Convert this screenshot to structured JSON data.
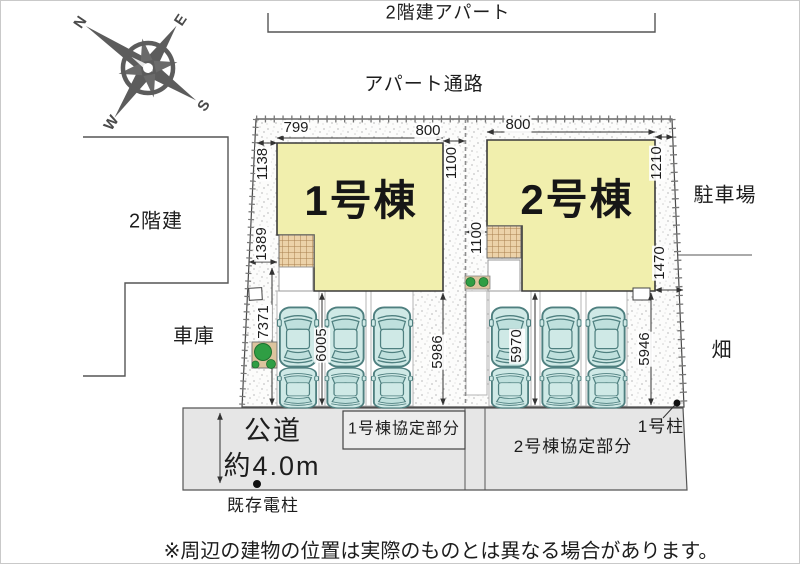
{
  "header": {
    "apartment_label": "2階建アパート",
    "passage_label": "アパート通路"
  },
  "compass": {
    "n": "N",
    "e": "E",
    "s": "S",
    "w": "W"
  },
  "surroundings": {
    "left_building": "2階建",
    "garage": "車庫",
    "parking_lot": "駐車場",
    "field": "畑"
  },
  "buildings": {
    "unit1": "1号棟",
    "unit2": "2号棟"
  },
  "road": {
    "name": "公道",
    "width": "約4.0m",
    "existing_pole": "既存電柱",
    "pole_no1": "1号柱",
    "agreement_unit1": "1号棟協定部分",
    "agreement_unit2": "2号棟協定部分"
  },
  "dimensions": {
    "b1_top_left": "799",
    "b1_top_right": "800",
    "b2_top_left": "800",
    "west_1": "1138",
    "west_2": "1389",
    "west_3": "7371",
    "center_north": "1100",
    "center_south": "1100",
    "east_north": "1210",
    "east_south": "1470",
    "p1_inner": "6005",
    "p1_east": "5986",
    "p2_inner": "5970",
    "p2_east": "5946"
  },
  "note": "※周辺の建物の位置は実際のものとは異なる場合があります。",
  "colors": {
    "building_fill": "#f1efad",
    "car_fill": "#cfe9e6",
    "terrace_fill": "#ecd2a9",
    "road_fill": "#e6e6e6",
    "tree_green": "#2f9e44"
  }
}
